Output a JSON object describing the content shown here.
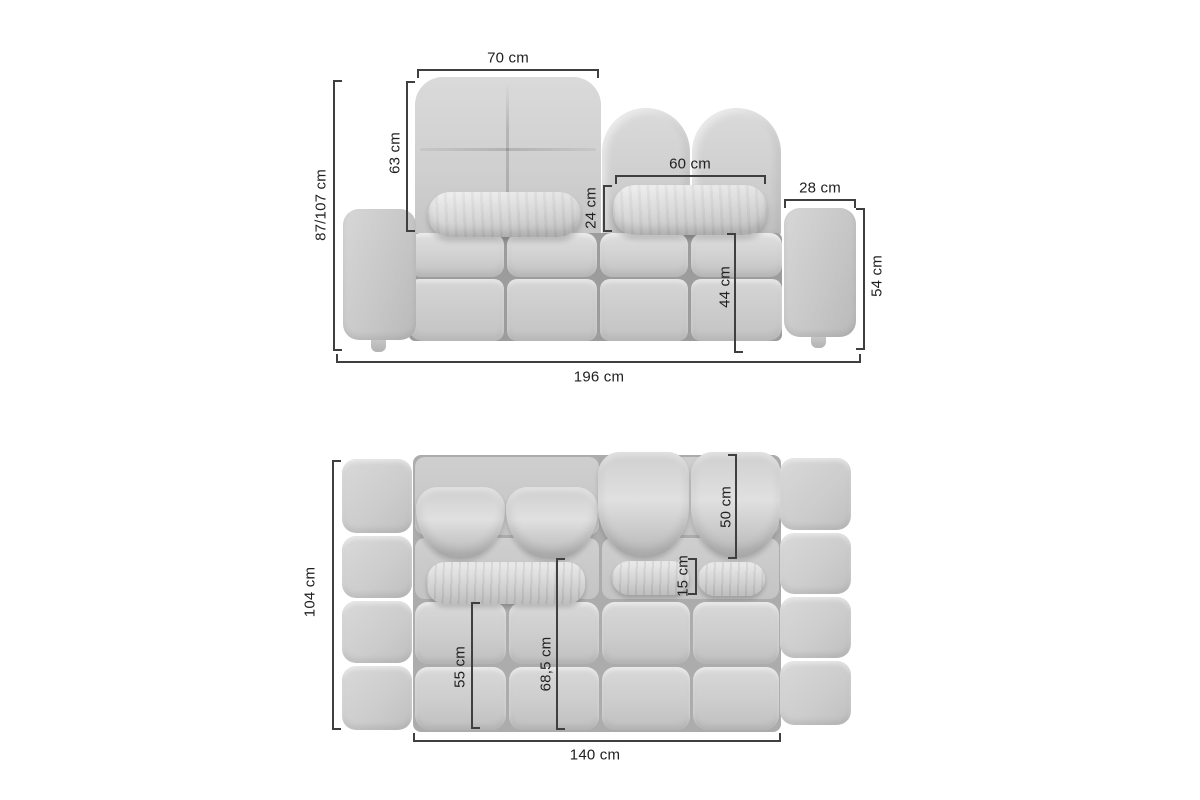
{
  "diagram_type": "sofa-dimension-drawing",
  "unit": "cm",
  "colors": {
    "background": "#ffffff",
    "dimension_line": "#3f3f3f",
    "label_text": "#212121",
    "sofa_base": "#cccccc",
    "sofa_highlight": "#e6e6e6",
    "sofa_shadow": "#9c9c9c"
  },
  "front_view": {
    "dim_backrest_width": "70 cm",
    "dim_backrest_height": "63 cm",
    "dim_total_height": "87/107 cm",
    "dim_headrest_cushion_width": "60 cm",
    "dim_headrest_cushion_height": "24 cm",
    "dim_side_table_width": "28 cm",
    "dim_side_table_height": "54 cm",
    "dim_seat_height": "44 cm",
    "dim_total_width": "196 cm"
  },
  "top_view": {
    "dim_total_depth": "104 cm",
    "dim_backrest_cushion_depth": "50 cm",
    "dim_pillow_depth": "15 cm",
    "dim_seat_depth": "55 cm",
    "dim_inner_depth": "68,5 cm",
    "dim_seat_width": "140 cm"
  }
}
